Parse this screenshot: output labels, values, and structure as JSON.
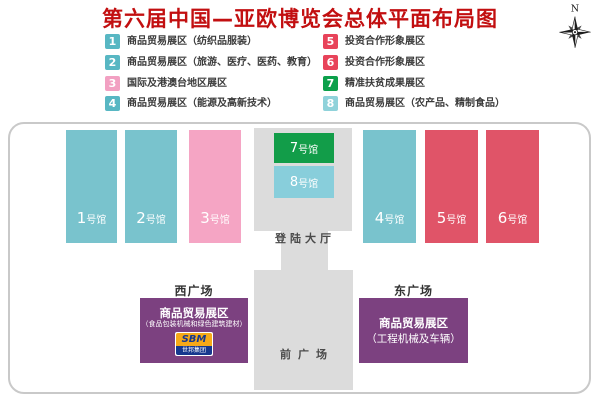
{
  "title": {
    "text": "第六届中国—亚欧博览会总体平面布局图",
    "color": "#c20f10"
  },
  "compass": {
    "north_label": "N"
  },
  "legend": {
    "items": [
      {
        "num": "1",
        "label": "商品贸易展区（纺织品服装）",
        "color": "#58b7c3"
      },
      {
        "num": "2",
        "label": "商品贸易展区（旅游、医疗、医药、教育）",
        "color": "#58b7c3"
      },
      {
        "num": "3",
        "label": "国际及港澳台地区展区",
        "color": "#f2a0c2"
      },
      {
        "num": "4",
        "label": "商品贸易展区（能源及高新技术）",
        "color": "#58b7c3"
      },
      {
        "num": "5",
        "label": "投资合作形象展区",
        "color": "#e8435a"
      },
      {
        "num": "6",
        "label": "投资合作形象展区",
        "color": "#e8435a"
      },
      {
        "num": "7",
        "label": "精准扶贫成果展区",
        "color": "#0ca04b"
      },
      {
        "num": "8",
        "label": "商品贸易展区（农产品、精制食品）",
        "color": "#8fd2da"
      }
    ]
  },
  "map": {
    "halls": [
      {
        "num": "1",
        "suffix": "号馆",
        "color": "#79c3cd"
      },
      {
        "num": "2",
        "suffix": "号馆",
        "color": "#79c3cd"
      },
      {
        "num": "3",
        "suffix": "号馆",
        "color": "#f5a5c4"
      },
      {
        "num": "4",
        "suffix": "号馆",
        "color": "#79c3cd"
      },
      {
        "num": "5",
        "suffix": "号馆",
        "color": "#e05468"
      },
      {
        "num": "6",
        "suffix": "号馆",
        "color": "#e05468"
      }
    ],
    "hall7": {
      "num": "7",
      "suffix": "号馆",
      "color": "#129d49"
    },
    "hall8": {
      "num": "8",
      "suffix": "号馆",
      "color": "#88cedb"
    },
    "landing_hall_label": "登陆大厅",
    "front_plaza_label": "前广场",
    "west_plaza_label": "西广场",
    "east_plaza_label": "东广场",
    "west_booth": {
      "line1": "商品贸易展区",
      "line2": "（食品包装机械和绿色建筑建材）",
      "logo_text": "SBM",
      "logo_subtext": "世邦集团",
      "color": "#7c4180"
    },
    "east_booth": {
      "line1": "商品贸易展区",
      "line2": "（工程机械及车辆）",
      "color": "#7c4180"
    }
  }
}
